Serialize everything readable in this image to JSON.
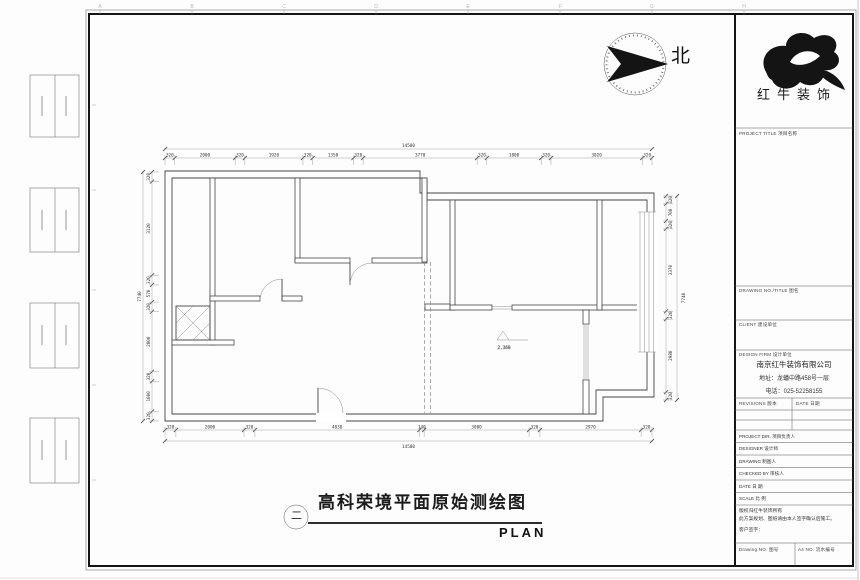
{
  "sheet": {
    "grid_letters_top": [
      "A",
      "B",
      "C",
      "D",
      "E",
      "F",
      "G",
      "H"
    ]
  },
  "north_arrow": {
    "label": "北"
  },
  "logo": {
    "name": "红牛装饰"
  },
  "title_bar": {
    "figure_number": "二",
    "title": "高科荣境平面原始测绘图",
    "subtitle": "PLAN"
  },
  "plan": {
    "level_marker": "2.360",
    "dims": {
      "top": [
        "320",
        "2000",
        "320",
        "1920",
        "320",
        "1350",
        "320",
        "3770",
        "320",
        "1800",
        "320",
        "3020",
        "320"
      ],
      "bottom": [
        "320",
        "2000",
        "320",
        "4830",
        "140",
        "3080",
        "320",
        "2970",
        "320"
      ],
      "left": [
        "320",
        "3120",
        "320",
        "570",
        "320",
        "2000",
        "320",
        "1000",
        "320"
      ],
      "right": [
        "320",
        "700",
        "320",
        "3370",
        "320",
        "2980",
        "320"
      ],
      "total_top": "14500",
      "total_bottom": "14500",
      "total_left": "7740",
      "total_right": "7740"
    }
  },
  "title_block": {
    "headers": {
      "project_title": "PROJECT TITLE 项目名称",
      "drawing_title": "DRAWING NO./TITLE 图名",
      "client": "CLIENT 建设单位",
      "design_firm": "DESIGN FIRM 设计单位"
    },
    "company": {
      "name": "南京红牛装饰有限公司",
      "address": "地址：龙蟠中路458号一层",
      "phone": "电话：025-52258155"
    },
    "revisions": {
      "label": "REVISIONS 版本",
      "date_label": "DATE 日期"
    },
    "rows": [
      {
        "label": "PROJECT DIR. 项目负责人"
      },
      {
        "label": "DESIGNER 设计师"
      },
      {
        "label": "DRAWING 制图人"
      },
      {
        "label": "CHECKED BY 审核人"
      },
      {
        "label": "DATE 日 期"
      },
      {
        "label": "SCALE 比 例"
      }
    ],
    "notes": [
      "版权归红牛装饰所有",
      "此方案规划、图纸请由本人签字确认后施工。",
      "客户签字："
    ],
    "footer": {
      "drawing_no": "Drawing NO. 图号",
      "serial_no": "A4 NO. 流水编号"
    }
  }
}
